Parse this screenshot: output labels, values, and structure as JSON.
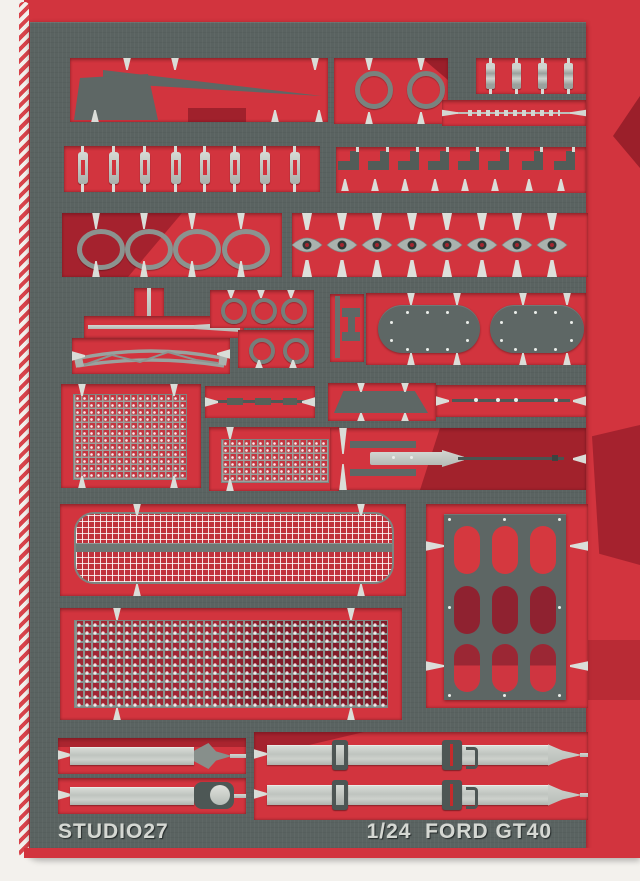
{
  "colors": {
    "bg_white": "#f3f1ed",
    "card_red": "#d2343e",
    "card_red_dark": "#8c1f2c",
    "fret_gray": "#5a6361",
    "part_silver": "#c3c8c4",
    "rivet_white": "#ebeeea",
    "text_silver": "#d5d8d3"
  },
  "footer": {
    "brand": "STUDIO27",
    "scale_title": "1/24  FORD GT40"
  }
}
